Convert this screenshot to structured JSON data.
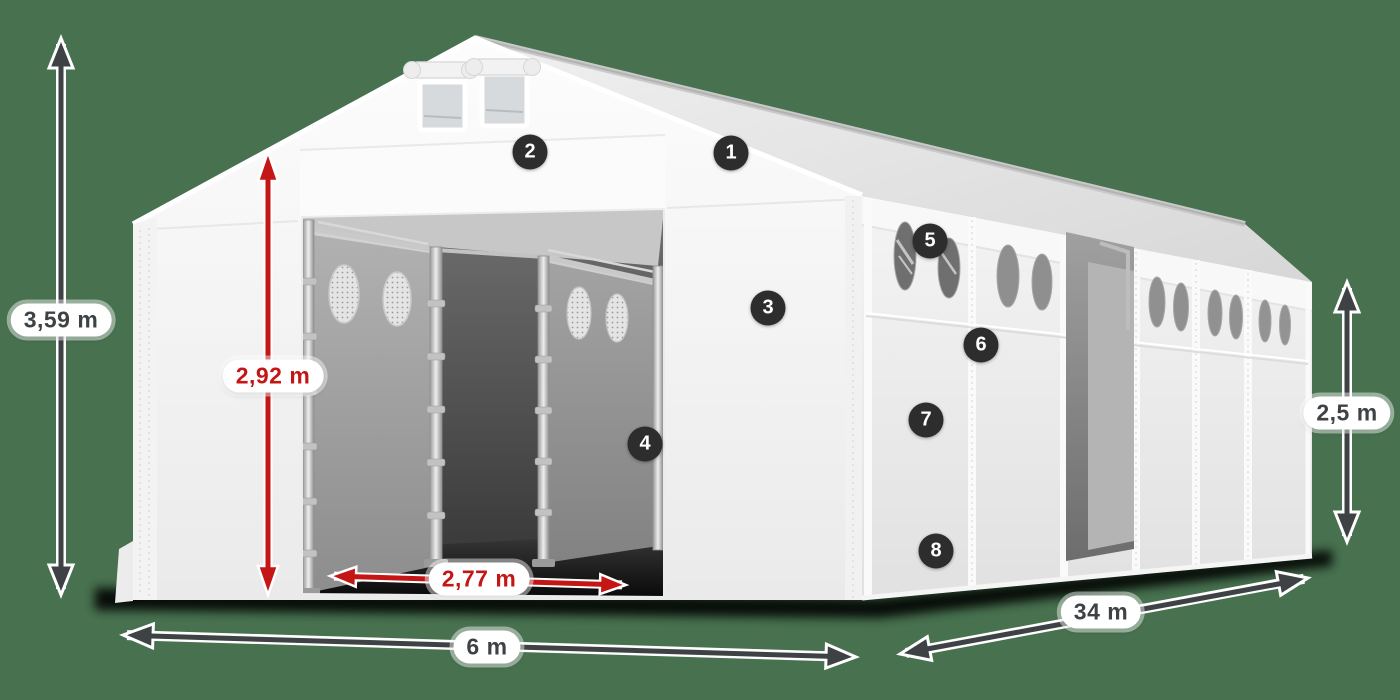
{
  "canvas": {
    "background": "#47714f"
  },
  "palette": {
    "accent_red": "#c51616",
    "dimension_gray": "#3e4245",
    "marker_bg": "#2d2d2d",
    "marker_text": "#ffffff",
    "tent_white": "#f5f5f5"
  },
  "dimensions": {
    "total_height": {
      "label": "3,59 m",
      "style": "gray"
    },
    "entrance_height": {
      "label": "2,92 m",
      "style": "red"
    },
    "entrance_width": {
      "label": "2,77 m",
      "style": "red"
    },
    "front_width": {
      "label": "6 m",
      "style": "gray"
    },
    "side_length": {
      "label": "34 m",
      "style": "gray"
    },
    "wall_height": {
      "label": "2,5 m",
      "style": "gray"
    }
  },
  "markers": [
    "1",
    "2",
    "3",
    "4",
    "5",
    "6",
    "7",
    "8"
  ]
}
